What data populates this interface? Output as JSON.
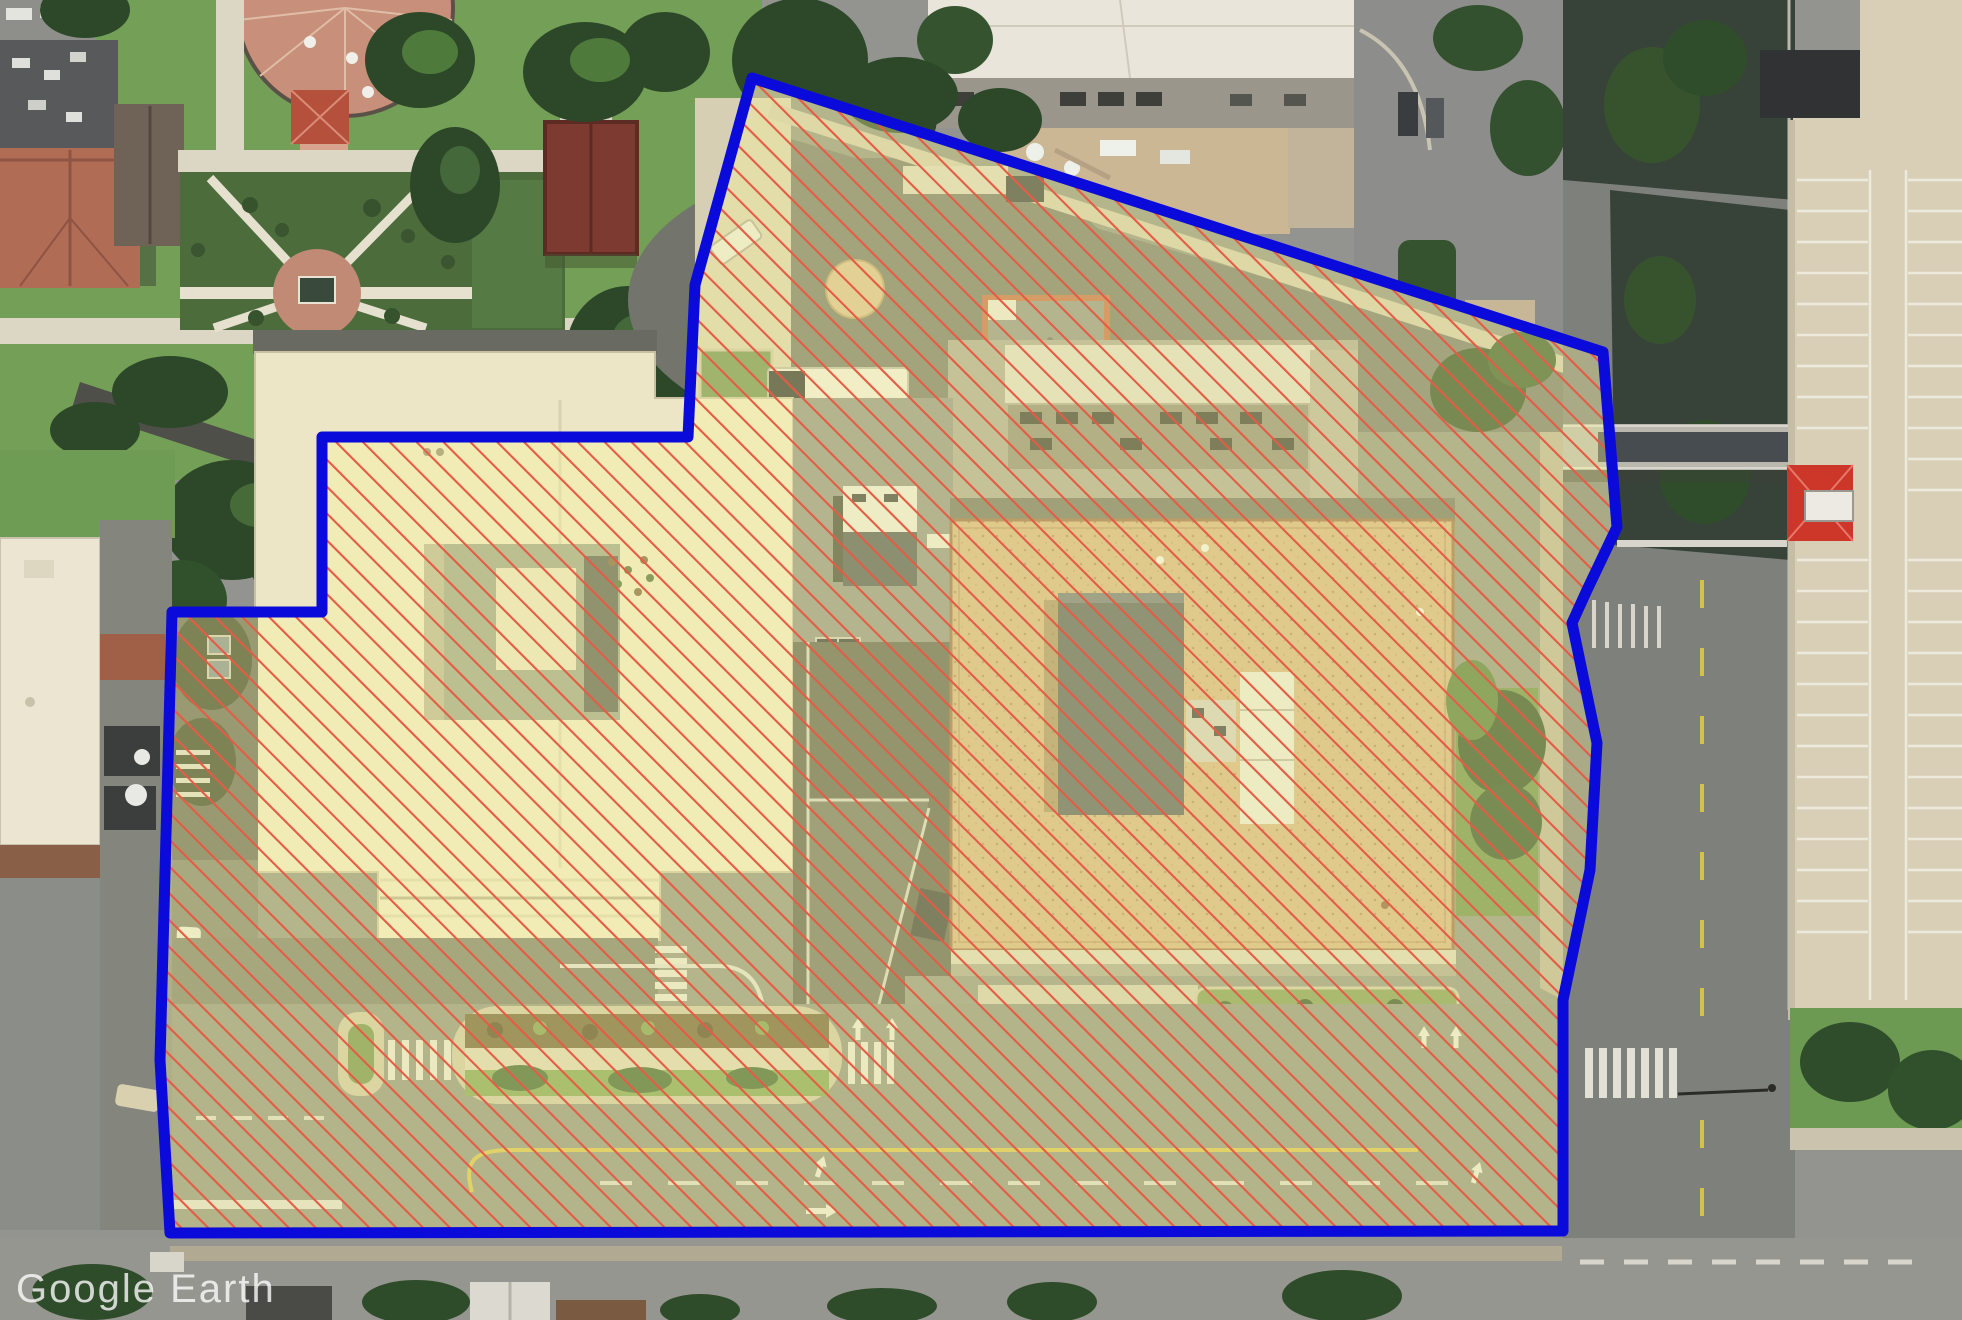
{
  "app": {
    "name": "Google Earth",
    "watermark_text": "Google Earth"
  },
  "overlay": {
    "type": "parcel-boundary-highlight",
    "boundary_color": "#0a0ada",
    "boundary_width": 11,
    "fill_tint": "rgba(250,246,152,0.36)",
    "hatch": {
      "color": "#e45c45",
      "line_width": 2.2,
      "spacing": 19,
      "angle_deg": -45
    },
    "boundary_points": [
      [
        752,
        78
      ],
      [
        1603,
        352
      ],
      [
        1617,
        527
      ],
      [
        1587,
        590
      ],
      [
        1572,
        623
      ],
      [
        1597,
        743
      ],
      [
        1590,
        870
      ],
      [
        1563,
        1000
      ],
      [
        1563,
        1231
      ],
      [
        170,
        1233
      ],
      [
        160,
        1060
      ],
      [
        172,
        612
      ],
      [
        322,
        612
      ],
      [
        322,
        437
      ],
      [
        688,
        437
      ],
      [
        695,
        285
      ]
    ]
  },
  "scene": {
    "imagery": "aerial-satellite",
    "landmarks": [
      {
        "name": "campus-gardens-northwest",
        "color": "#72a257"
      },
      {
        "name": "circular-brick-plaza",
        "color": "#c8907a"
      },
      {
        "name": "terracotta-roof-building",
        "color": "#b06c54"
      },
      {
        "name": "maroon-roof-building",
        "color": "#7c3a31"
      },
      {
        "name": "institutional-building-north",
        "color": "#e9e5da"
      },
      {
        "name": "left-office-building-cream-roof",
        "color": "#ece5c6"
      },
      {
        "name": "right-office-building-tan-roof",
        "color": "#d1b184"
      },
      {
        "name": "rooftop-penthouse",
        "color": "#565b61"
      },
      {
        "name": "central-service-deck",
        "color": "#8e9188"
      },
      {
        "name": "east-street",
        "color": "#7e807c"
      },
      {
        "name": "pedestrian-bridge",
        "color": "#b9b7ae"
      },
      {
        "name": "parking-structure-east",
        "color": "#d9cfb6"
      },
      {
        "name": "red-roof-kiosk",
        "color": "#cc372a"
      },
      {
        "name": "south-avenue",
        "color": "#8c8f80"
      },
      {
        "name": "median-planter",
        "color": "#c9c2a6"
      }
    ]
  }
}
